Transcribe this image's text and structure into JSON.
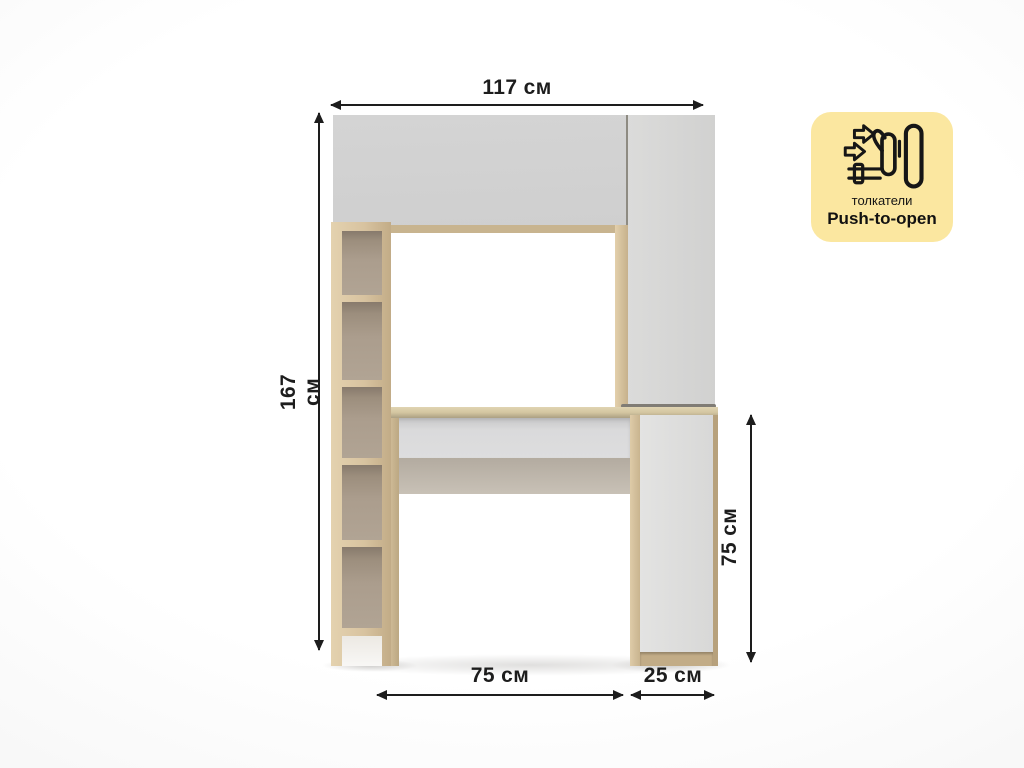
{
  "canvas": {
    "width": 1024,
    "height": 768,
    "background": "#FFFFFF"
  },
  "dimensions": {
    "top_width": "117 см",
    "left_height": "167 см",
    "right_height": "75 см",
    "bottom_left_width": "75 см",
    "bottom_right_width": "25 см"
  },
  "badge": {
    "background": "#FBE7A0",
    "label_ru": "толкатели",
    "label_en": "Push-to-open",
    "icon": "hand-pushing-door-with-arrows"
  },
  "palette": {
    "wood_light": "#E2CFAC",
    "wood": "#D3BE9A",
    "wood_dark": "#C8B48F",
    "panel_gray": "#D4D4D4",
    "panel_light": "#DEDEDE",
    "shelf_interior": "#B1A494",
    "dimension_color": "#1D1D1D"
  },
  "furniture": {
    "description": "White and light-oak desk with overhead cabinet, left open shelving column, right wardrobe side cabinet and lower pedestal"
  }
}
